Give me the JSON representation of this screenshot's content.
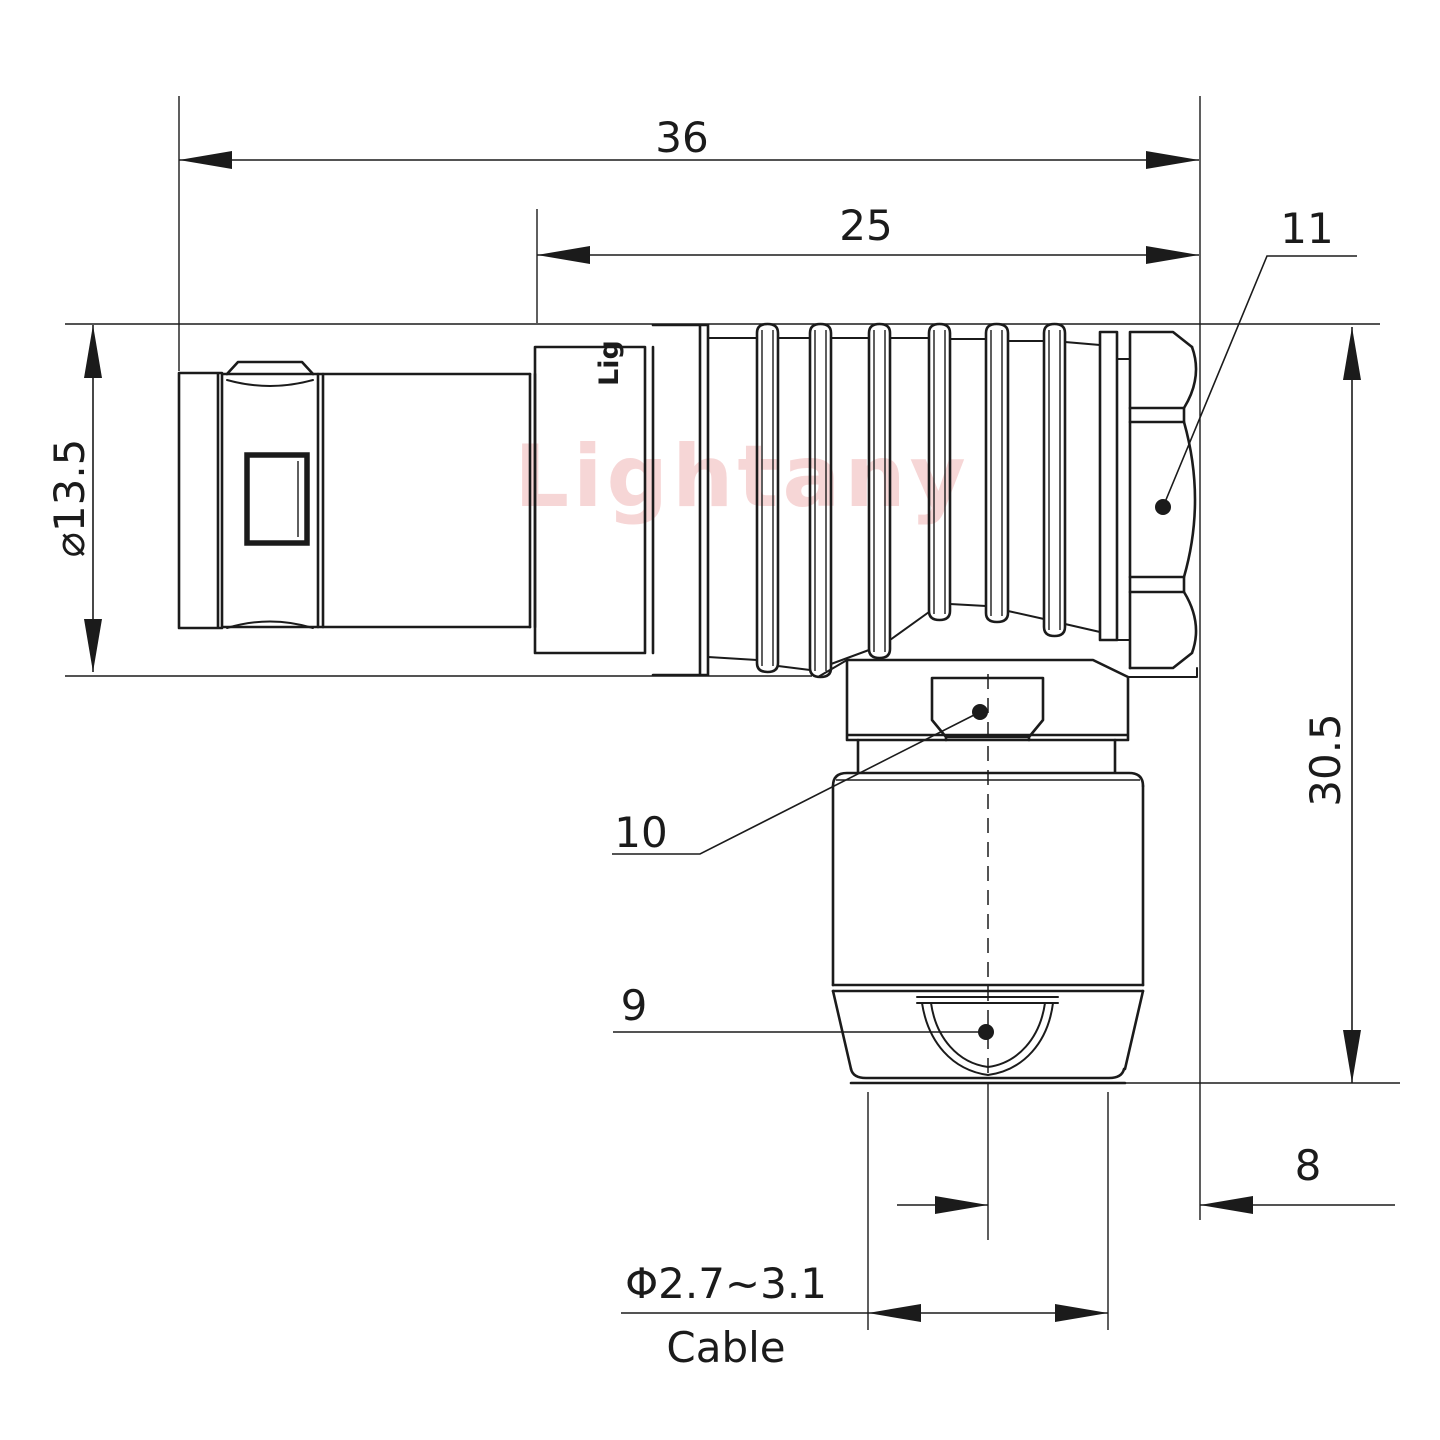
{
  "dimensions": {
    "overall_length": "36",
    "boot_length": "25",
    "front_diameter": "⌀13.5",
    "height": "30.5",
    "offset": "8",
    "cable_diameter": "Φ2.7~3.1",
    "cable_label": "Cable"
  },
  "callouts": {
    "backnut": "11",
    "clamp_nut": "10",
    "cable_sleeve": "9"
  },
  "branding": {
    "watermark": "Lightany",
    "engraving": "Lig"
  },
  "colors": {
    "line_color": "#1b1b1b",
    "watermark_color": "#efaeae"
  }
}
